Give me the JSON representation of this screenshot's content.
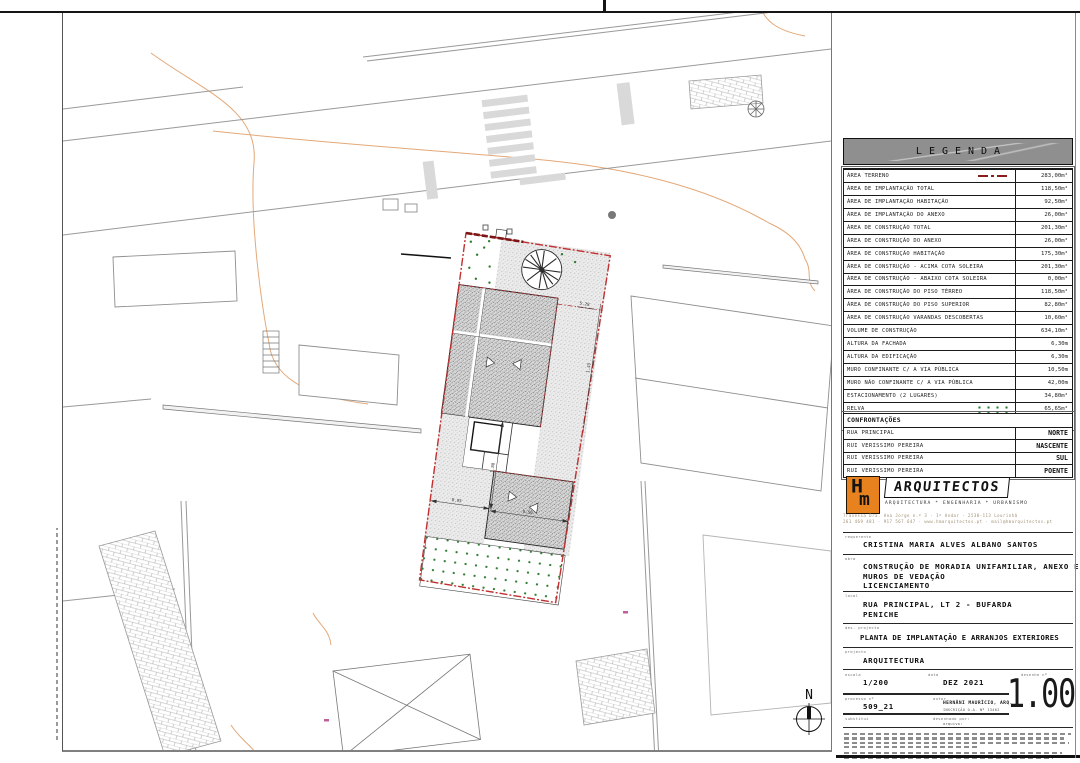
{
  "legend": {
    "title": "LEGENDA",
    "rows": [
      {
        "label": "ÁREA TERRENO",
        "value": "283,00m²",
        "symbol": "red-dashdot"
      },
      {
        "label": "ÁREA DE IMPLANTAÇÃO TOTAL",
        "value": "118,50m²"
      },
      {
        "label": "ÁREA DE IMPLANTAÇÃO HABITAÇÃO",
        "value": "92,50m²"
      },
      {
        "label": "ÁREA DE IMPLANTAÇÃO DO ANEXO",
        "value": "26,00m²"
      },
      {
        "label": "ÁREA DE CONSTRUÇÃO TOTAL",
        "value": "201,30m²"
      },
      {
        "label": "ÁREA DE CONSTRUÇÃO DO ANEXO",
        "value": "26,00m²"
      },
      {
        "label": "ÁREA DE CONSTRUÇÃO HABITAÇÃO",
        "value": "175,30m²"
      },
      {
        "label": "ÁREA DE CONSTRUÇÃO - ACIMA COTA SOLEIRA",
        "value": "201,30m²"
      },
      {
        "label": "ÁREA DE CONSTRUÇÃO - ABAIXO COTA SOLEIRA",
        "value": "0,00m²"
      },
      {
        "label": "ÁREA DE CONSTRUÇÃO DO PISO TÉRREO",
        "value": "118,50m²"
      },
      {
        "label": "ÁREA DE CONSTRUÇÃO DO PISO SUPERIOR",
        "value": "82,80m²"
      },
      {
        "label": "ÁREA DE CONSTRUÇÃO VARANDAS DESCOBERTAS",
        "value": "10,60m²"
      },
      {
        "label": "VOLUME DE CONSTRUÇÃO",
        "value": "634,10m³"
      },
      {
        "label": "ALTURA DA FACHADA",
        "value": "6,30m"
      },
      {
        "label": "ALTURA DA EDIFICAÇÃO",
        "value": "6,30m"
      },
      {
        "label": "MURO CONFINANTE C/ A VIA PÚBLICA",
        "value": "10,50m"
      },
      {
        "label": "MURO NÃO CONFINANTE C/ A VIA PÚBLICA",
        "value": "42,00m"
      },
      {
        "label": "ESTACIONAMENTO (2 LUGARES)",
        "value": "34,80m²"
      },
      {
        "label": "RELVA",
        "value": "65,65m²",
        "symbol": "grass"
      },
      {
        "label": "PAVÉ",
        "value": "96,60m²",
        "symbol": "pave"
      }
    ]
  },
  "confrontacoes": {
    "title": "CONFRONTAÇÕES",
    "rows": [
      {
        "label": "RUA PRINCIPAL",
        "value": "NORTE"
      },
      {
        "label": "RUI VERISSIMO PEREIRA",
        "value": "NASCENTE"
      },
      {
        "label": "RUI VERISSIMO PEREIRA",
        "value": "SUL"
      },
      {
        "label": "RUI VERISSIMO PEREIRA",
        "value": "POENTE"
      }
    ]
  },
  "firm": {
    "logo_h": "H",
    "logo_m": "m",
    "name": "ARQUITECTOS",
    "tagline": "ARQUITECTURA * ENGENHARIA * URBANISMO",
    "address_line1": "Travessa Dra. Ana Jorge n.º 3 · 1º Andar · 2530-113 Lourinhã",
    "address_line2": "261 469 481 · 917 567 647 · www.hmarquitectos.pt · mail@hmarquitectos.pt"
  },
  "titleblock": {
    "requerente_label": "requerente",
    "requerente": "CRISTINA MARIA ALVES ALBANO SANTOS",
    "obra_label": "obra",
    "obra_line1": "CONSTRUÇÃO DE MORADIA UNIFAMILIAR, ANEXO E",
    "obra_line2": "MUROS DE VEDAÇÃO",
    "obra_line3": "LICENCIAMENTO",
    "local_label": "local",
    "local_line1": "RUA PRINCIPAL, LT 2 - BUFARDA",
    "local_line2": "PENICHE",
    "des_label": "des. projecto",
    "des": "PLANTA DE IMPLANTAÇÃO E ARRANJOS EXTERIORES",
    "projecto_label": "projecto",
    "projecto": "ARQUITECTURA",
    "escala_label": "escala",
    "escala": "1/200",
    "data_label": "data",
    "data": "DEZ 2021",
    "desenho_label": "desenho nº",
    "desenho": "1.00",
    "processo_label": "processo nº",
    "processo": "509_21",
    "autor_label": "autor",
    "autor_line1": "HERNÂNI MAURÍCIO, ARQ.",
    "autor_line2": "INSCRIÇÃO O.A. Nº 13462",
    "substitui_label": "substitui",
    "desenhado_label": "desenhado por:",
    "arquivo_label": "arquivo:"
  },
  "plan": {
    "north_label": "N",
    "dims": [
      "8.95",
      "1.88",
      "9.50",
      "1.45",
      "5.28"
    ]
  }
}
